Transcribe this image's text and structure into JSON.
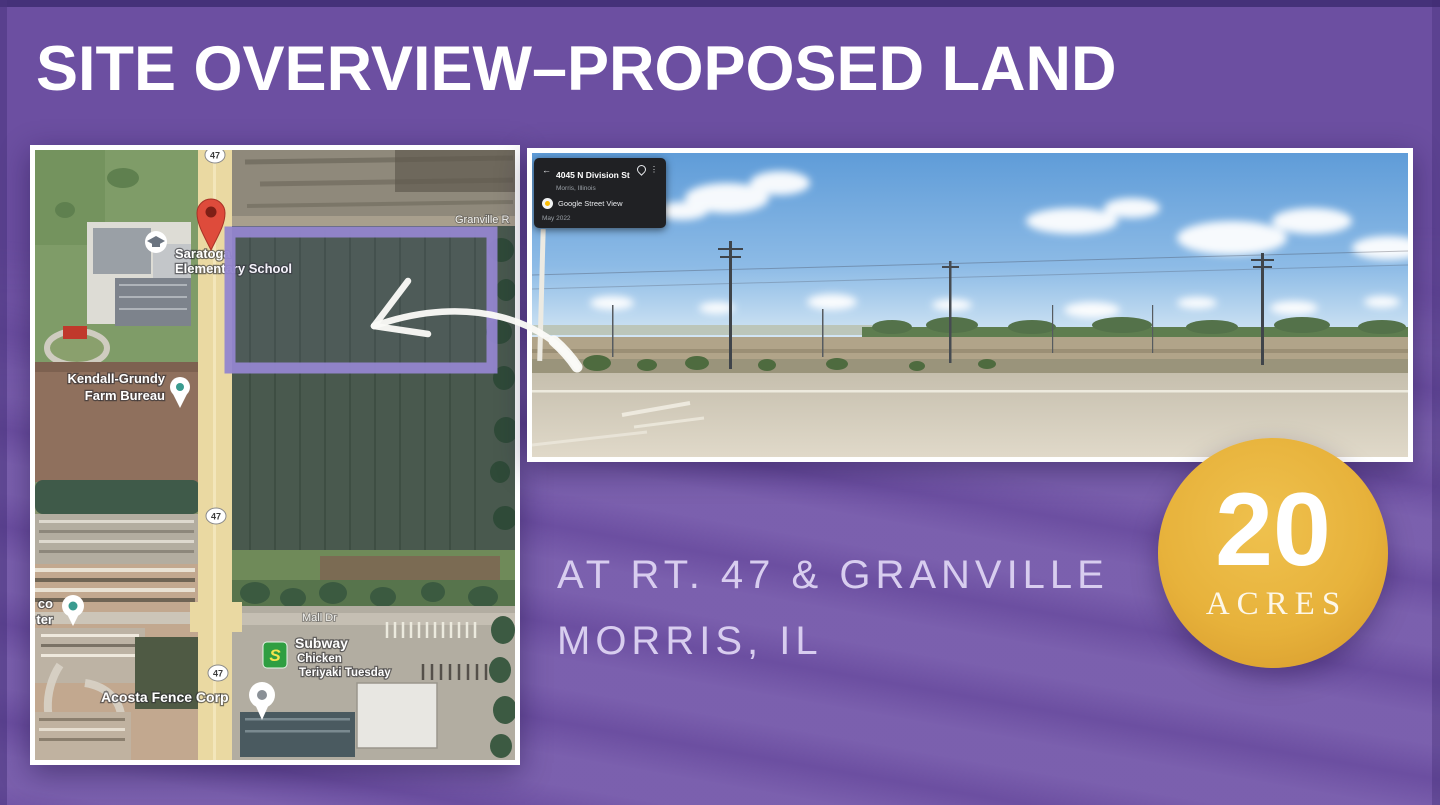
{
  "header": {
    "title": "SITE OVERVIEW–PROPOSED LAND"
  },
  "map": {
    "route_shield": "47",
    "labels": {
      "school_line1": "Saratoga",
      "school_line2": "Elementary School",
      "granville_road": "Granville R",
      "kendall_line1": "Kendall-Grundy",
      "kendall_line2": "Farm Bureau",
      "partial_left_line1": "co",
      "partial_left_line2": "ter",
      "mall_dr": "Mall Dr",
      "subway": "Subway",
      "subway_sub1": "Chicken",
      "subway_sub2": "Teriyaki Tuesday",
      "subway_logo_letter": "S",
      "acosta": "Acosta Fence Corp"
    }
  },
  "streetview": {
    "card": {
      "address": "4045 N Division St",
      "city": "Morris, Illinois",
      "product": "Google Street View",
      "date": "May 2022"
    }
  },
  "location": {
    "line1": "AT RT. 47 & GRANVILLE",
    "line2": "MORRIS, IL"
  },
  "badge": {
    "value": "20",
    "unit": "ACRES"
  },
  "colors": {
    "background": "#6C4FA1",
    "highlight": "#9486CF",
    "badge_gold": "#E7B23B",
    "title_white": "#FFFFFF"
  }
}
